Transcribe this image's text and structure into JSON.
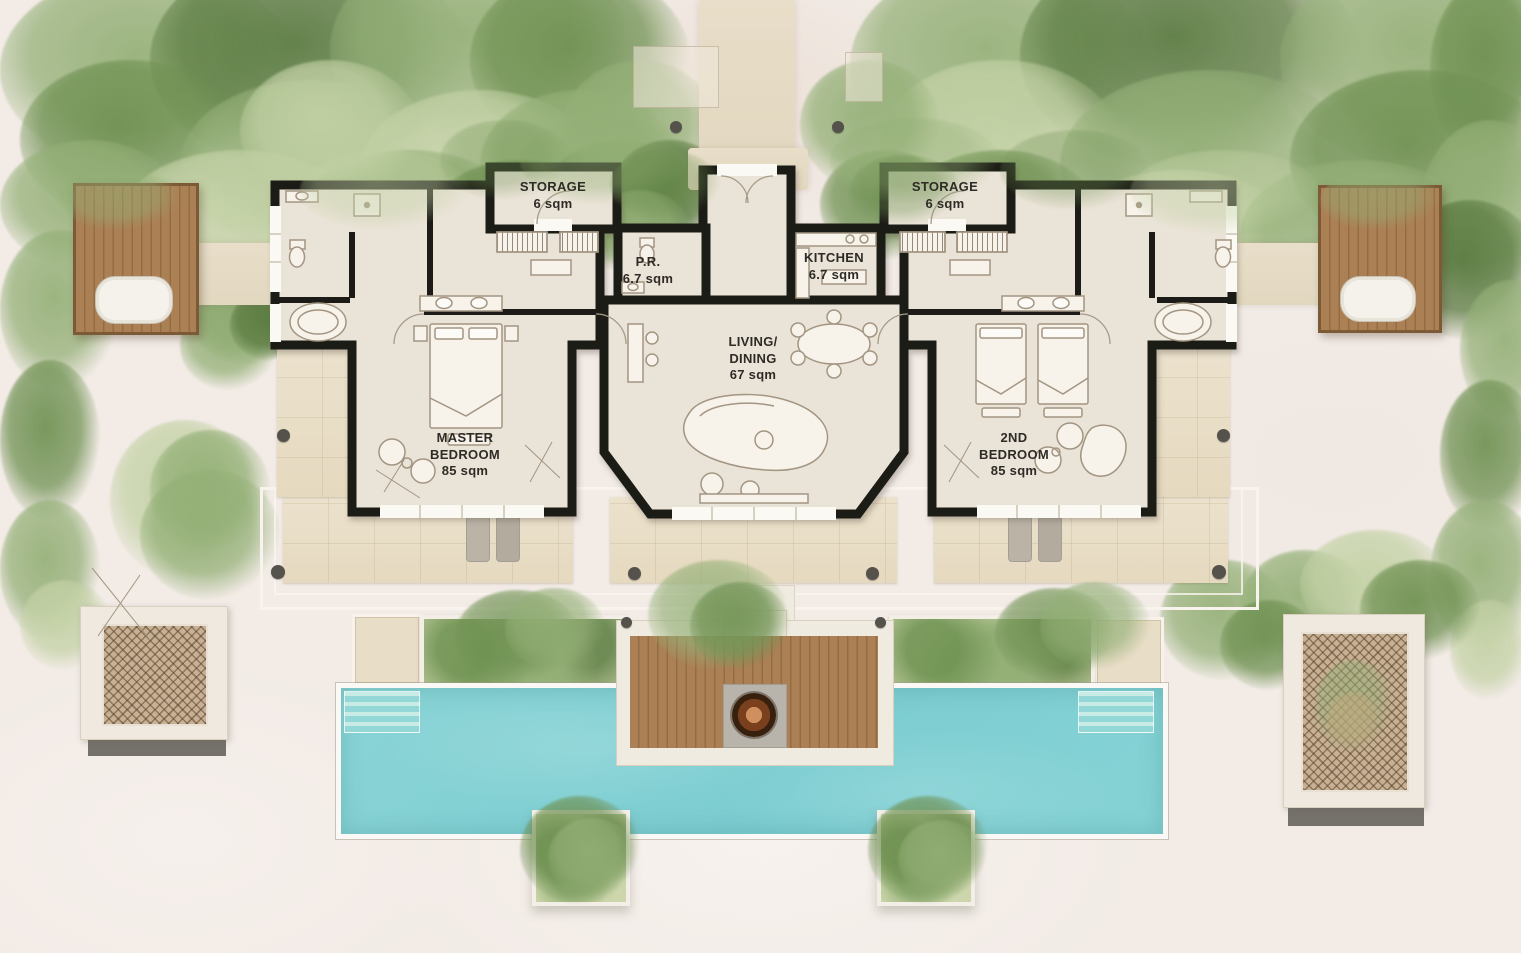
{
  "rooms": {
    "storage_left": {
      "name": "STORAGE",
      "area": "6 sqm"
    },
    "storage_right": {
      "name": "STORAGE",
      "area": "6 sqm"
    },
    "powder_room": {
      "name": "P.R.",
      "area": "6.7 sqm"
    },
    "kitchen": {
      "name": "KITCHEN",
      "area": "6.7 sqm"
    },
    "living_dining": {
      "line1": "LIVING/",
      "line2": "DINING",
      "area": "67 sqm"
    },
    "master_bedroom": {
      "line1": "MASTER",
      "line2": "BEDROOM",
      "area": "85 sqm"
    },
    "second_bedroom": {
      "line1": "2ND",
      "line2": "BEDROOM",
      "area": "85 sqm"
    }
  },
  "palette": {
    "sand": "#f2ebe6",
    "wall": "#1c1b18",
    "floor": "#eae3d7",
    "terrace_stone": "#e9dec7",
    "wood_deck": "#a97e52",
    "pool_water": "#84d2d5",
    "pool_rim": "#fbf9f5",
    "veg_pale": "#c4d2a6",
    "veg_mid": "#94b077",
    "veg_deep": "#6f9152",
    "veg_dark": "#597a40",
    "lattice_tan": "#c8b093",
    "fire_bowl": "#b5652e",
    "column_dot": "#55524b",
    "label_text": "#2e2b26",
    "furniture_stroke": "#a39582"
  },
  "features": [
    "left-outdoor-bath-deck",
    "right-outdoor-bath-deck",
    "outdoor-bathtubs",
    "swimming-pool",
    "pool-steps",
    "fire-bowl-deck",
    "planting-beds",
    "privacy-screen-left",
    "privacy-screen-right",
    "sun-loungers",
    "terraces",
    "entrance-path",
    "garden-vegetation",
    "bottom-planters"
  ]
}
